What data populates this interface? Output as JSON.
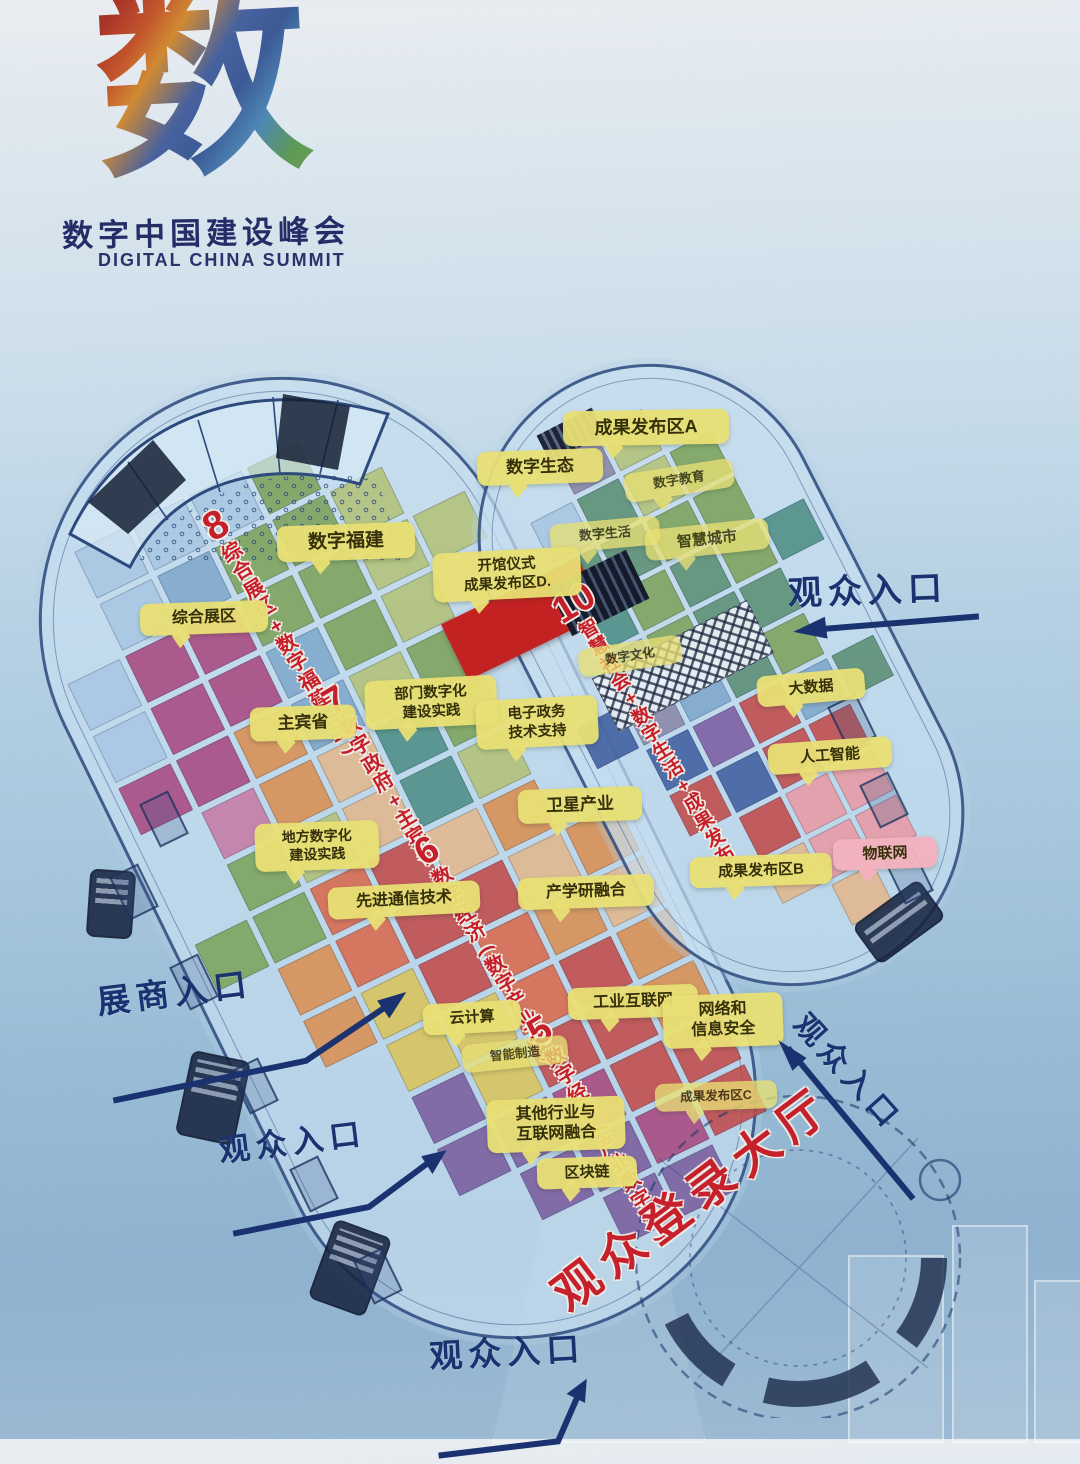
{
  "logo": {
    "glyph": "数",
    "title": "数字中国建设峰会",
    "subtitle": "DIGITAL CHINA SUMMIT"
  },
  "map": {
    "login_hall": {
      "label": "观众登录大厅",
      "x": 556,
      "y": 1262,
      "rot": -37,
      "fs": 47
    },
    "hall_titles": [
      {
        "id": "hall-8",
        "num": "8",
        "text": "综合展区+数字福建(二)",
        "x": 196,
        "y": 514,
        "rot": -31,
        "fs": 20,
        "numfs": 40
      },
      {
        "id": "hall-7",
        "num": "7",
        "text": "数字政府+主宾省",
        "x": 316,
        "y": 690,
        "rot": -31,
        "fs": 20,
        "numfs": 38
      },
      {
        "id": "hall-6",
        "num": "6",
        "text": "数字经济(数字产业化)",
        "x": 408,
        "y": 840,
        "rot": -31,
        "fs": 20,
        "numfs": 38
      },
      {
        "id": "hall-5",
        "num": "5",
        "text": "数字经济(产业数字化)",
        "x": 521,
        "y": 1020,
        "rot": -31,
        "fs": 20,
        "numfs": 38
      },
      {
        "id": "hall-10",
        "num": "10",
        "text": "智慧社会+数字生活+成果发布区",
        "x": 546,
        "y": 598,
        "rot": -31,
        "fs": 19,
        "numfs": 38
      }
    ],
    "callouts": [
      {
        "id": "results-a",
        "lines": [
          "成果发布区A"
        ],
        "x": 563,
        "y": 410,
        "w": 152,
        "fs": 18,
        "rot": -1
      },
      {
        "id": "digital-ecology",
        "lines": [
          "数字生态"
        ],
        "x": 477,
        "y": 450,
        "w": 112,
        "fs": 17,
        "rot": -2
      },
      {
        "id": "digital-education",
        "lines": [
          "数字教育"
        ],
        "x": 624,
        "y": 466,
        "w": 96,
        "fs": 13,
        "rot": -9,
        "faded": true
      },
      {
        "id": "digital-life",
        "lines": [
          "数字生活"
        ],
        "x": 550,
        "y": 520,
        "w": 96,
        "fs": 13,
        "rot": -5,
        "faded": true
      },
      {
        "id": "smart-city",
        "lines": [
          "智慧城市"
        ],
        "x": 645,
        "y": 524,
        "w": 110,
        "fs": 15,
        "rot": -6,
        "faded": true
      },
      {
        "id": "digital-culture",
        "lines": [
          "数字文化"
        ],
        "x": 578,
        "y": 642,
        "w": 90,
        "fs": 12.5,
        "rot": -9,
        "faded": true,
        "tail": false
      },
      {
        "id": "big-data",
        "lines": [
          "大数据"
        ],
        "x": 757,
        "y": 672,
        "w": 94,
        "fs": 15,
        "rot": -5
      },
      {
        "id": "ai",
        "lines": [
          "人工智能"
        ],
        "x": 768,
        "y": 740,
        "w": 110,
        "fs": 15,
        "rot": -4
      },
      {
        "id": "results-b",
        "lines": [
          "成果发布区B"
        ],
        "x": 690,
        "y": 855,
        "w": 128,
        "fs": 15,
        "rot": -2
      },
      {
        "id": "iot",
        "lines": [
          "物联网"
        ],
        "x": 833,
        "y": 838,
        "w": 90,
        "fs": 15,
        "rot": -2,
        "variant": "pink"
      },
      {
        "id": "digital-fujian",
        "lines": [
          "数字福建"
        ],
        "x": 277,
        "y": 524,
        "w": 124,
        "fs": 19,
        "rot": -2
      },
      {
        "id": "general-zone",
        "lines": [
          "综合展区"
        ],
        "x": 140,
        "y": 602,
        "w": 114,
        "fs": 16,
        "rot": -2
      },
      {
        "id": "opening-results-d",
        "lines": [
          "开馆仪式",
          "成果发布区D."
        ],
        "x": 433,
        "y": 550,
        "w": 134,
        "fs": 14.5,
        "rot": -3
      },
      {
        "id": "host-province",
        "lines": [
          "主宾省"
        ],
        "x": 250,
        "y": 706,
        "w": 92,
        "fs": 17,
        "rot": -2
      },
      {
        "id": "dept-digitalization",
        "lines": [
          "部门数字化",
          "建设实践"
        ],
        "x": 365,
        "y": 678,
        "w": 118,
        "fs": 14.5,
        "rot": -3
      },
      {
        "id": "e-gov-support",
        "lines": [
          "电子政务",
          "技术支持"
        ],
        "x": 476,
        "y": 698,
        "w": 108,
        "fs": 14.5,
        "rot": -3
      },
      {
        "id": "local-digitalization",
        "lines": [
          "地方数字化",
          "建设实践"
        ],
        "x": 255,
        "y": 822,
        "w": 110,
        "fs": 14,
        "rot": -2
      },
      {
        "id": "satellite-industry",
        "lines": [
          "卫星产业"
        ],
        "x": 518,
        "y": 788,
        "w": 110,
        "fs": 17,
        "rot": -2
      },
      {
        "id": "adv-comm-tech",
        "lines": [
          "先进通信技术"
        ],
        "x": 328,
        "y": 884,
        "w": 138,
        "fs": 16,
        "rot": -3
      },
      {
        "id": "industry-academia",
        "lines": [
          "产学研融合"
        ],
        "x": 518,
        "y": 876,
        "w": 122,
        "fs": 16,
        "rot": -2
      },
      {
        "id": "cloud-computing",
        "lines": [
          "云计算"
        ],
        "x": 423,
        "y": 1002,
        "w": 84,
        "fs": 15,
        "rot": -3
      },
      {
        "id": "smart-manufacturing",
        "lines": [
          "智能制造"
        ],
        "x": 462,
        "y": 1040,
        "w": 92,
        "fs": 12.5,
        "rot": -6,
        "faded": true,
        "tail": false
      },
      {
        "id": "industrial-internet",
        "lines": [
          "工业互联网"
        ],
        "x": 568,
        "y": 986,
        "w": 116,
        "fs": 16,
        "rot": -2
      },
      {
        "id": "network-security",
        "lines": [
          "网络和",
          "信息安全"
        ],
        "x": 663,
        "y": 994,
        "w": 106,
        "fs": 16,
        "rot": -2
      },
      {
        "id": "results-c",
        "lines": [
          "成果发布区C"
        ],
        "x": 655,
        "y": 1082,
        "w": 108,
        "fs": 12.5,
        "rot": -2,
        "faded": true
      },
      {
        "id": "other-industries",
        "lines": [
          "其他行业与",
          "互联网融合"
        ],
        "x": 487,
        "y": 1098,
        "w": 124,
        "fs": 16,
        "rot": -2
      },
      {
        "id": "blockchain",
        "lines": [
          "区块链"
        ],
        "x": 537,
        "y": 1157,
        "w": 86,
        "fs": 15,
        "rot": -2
      }
    ],
    "entrances": [
      {
        "id": "visitor-entrance-ne",
        "label": "观众入口",
        "x": 787,
        "y": 566,
        "rot": -2,
        "fs": 34,
        "arrow": {
          "w": 196,
          "h": 26,
          "line": "190,8 16,16",
          "head": "36,3 4,17 38,25"
        }
      },
      {
        "id": "exhibitor-entrance-w",
        "label": "展商入口",
        "x": 94,
        "y": 976,
        "rot": -7,
        "fs": 33,
        "arrow": {
          "w": 314,
          "h": 84,
          "line": "4,78 200,62 294,14",
          "head": "308,6 288,30 278,11"
        }
      },
      {
        "id": "visitor-entrance-w",
        "label": "观众入口",
        "x": 216,
        "y": 1126,
        "rot": -7,
        "fs": 31,
        "arrow": {
          "w": 238,
          "h": 70,
          "line": "4,64 142,54 212,14",
          "head": "226,7 209,29 200,10"
        }
      },
      {
        "id": "visitor-entrance-s",
        "label": "观众入口",
        "x": 428,
        "y": 1330,
        "rot": -3,
        "fs": 33,
        "arrow": {
          "w": 176,
          "h": 86,
          "line": "4,78 124,70 148,22",
          "head": "156,9 153,33 135,23"
        }
      },
      {
        "id": "visitor-entrance-e",
        "label": "观众入口",
        "x": 818,
        "y": 1002,
        "rot": 48,
        "fs": 30,
        "arrow": {
          "w": 214,
          "h": 24,
          "line": "210,17 14,9",
          "head": "34,2 2,11 34,21"
        }
      }
    ],
    "halls": {
      "palette": {
        "L": "#a9c7e3",
        "S": "#7fa8cc",
        "N": "#3f5fa0",
        "D": "#2f4f78",
        "G": "#7da35c",
        "g": "#b3c279",
        "T": "#4e8e86",
        "t": "#76a89a",
        "M": "#a8497f",
        "m": "#c77ba6",
        "P": "#7b5ea0",
        "R": "#c14b4b",
        "r": "#d8694e",
        "O": "#d98f52",
        "o": "#e2b88d",
        "Y": "#d9c35b",
        "K": "#e89aa4",
        "E": "#5b8f74",
        "U": "#8a87a8"
      },
      "left": {
        "rows": [
          ".LLLG..",
          ".LSGGg.",
          "LMMGGgg",
          "LMMSGg.",
          "MMOSgG.",
          ".mOoTG.",
          ".GgoTg.",
          "GGrRoO.",
          ".OrRRoO",
          ".OYRrOo",
          "..YYrRO",
          "..PYRRO",
          "..PPMRR",
          "...PPMR",
          "....PP."
        ]
      },
      "right": {
        "rows": [
          "..Ug..",
          ".LEgG.",
          "LEEGG.",
          ".TGEGT",
          ".SGEE.",
          "NUSEG.",
          ".NPRSE",
          ".RNRR.",
          "..RKK.",
          "..oKK.",
          "...o.."
        ]
      }
    }
  }
}
